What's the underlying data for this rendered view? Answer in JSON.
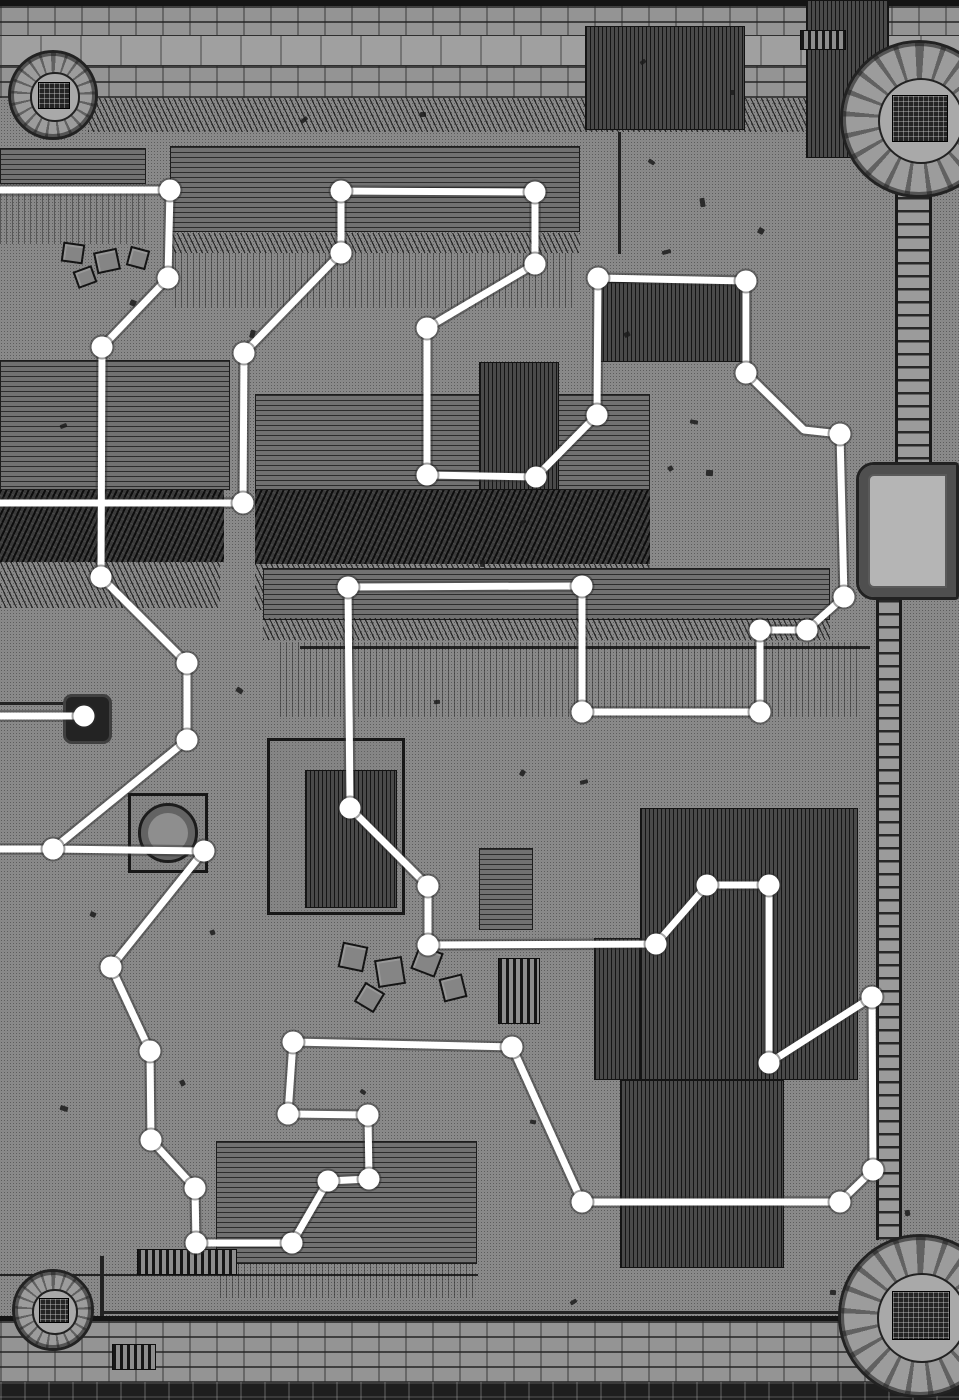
{
  "canvas": {
    "width": 959,
    "height": 1400
  },
  "colors": {
    "ground": "#a7a7a7",
    "ink": "#1b1b1b",
    "route_stroke": "#ffffff",
    "route_halo": "#2f2f2f"
  },
  "route_overlay": {
    "stroke_width": 7,
    "halo_width": 11.5,
    "node_radius": 10.5,
    "routes": [
      {
        "name": "main-route",
        "points": [
          [
            0,
            503
          ],
          [
            243,
            503
          ],
          [
            244,
            353
          ],
          [
            341,
            253
          ],
          [
            341,
            191
          ],
          [
            535,
            192
          ],
          [
            535,
            264
          ],
          [
            427,
            328
          ],
          [
            427,
            475
          ],
          [
            536,
            477
          ],
          [
            597,
            415
          ],
          [
            598,
            278
          ],
          [
            746,
            281
          ],
          [
            746,
            373
          ],
          [
            804,
            430
          ],
          [
            840,
            434
          ],
          [
            844,
            597
          ],
          [
            807,
            630
          ],
          [
            760,
            630
          ],
          [
            760,
            712
          ],
          [
            582,
            712
          ],
          [
            582,
            586
          ],
          [
            348,
            587
          ],
          [
            350,
            808
          ],
          [
            428,
            886
          ],
          [
            428,
            945
          ],
          [
            656,
            944
          ],
          [
            707,
            885
          ],
          [
            769,
            885
          ],
          [
            769,
            1063
          ],
          [
            872,
            997
          ],
          [
            873,
            1170
          ],
          [
            840,
            1202
          ],
          [
            582,
            1202
          ],
          [
            512,
            1047
          ],
          [
            293,
            1042
          ],
          [
            288,
            1114
          ],
          [
            368,
            1115
          ],
          [
            369,
            1179
          ],
          [
            328,
            1181
          ],
          [
            292,
            1243
          ],
          [
            196,
            1243
          ],
          [
            195,
            1188
          ],
          [
            151,
            1140
          ],
          [
            150,
            1051
          ],
          [
            111,
            967
          ],
          [
            204,
            851
          ],
          [
            53,
            849
          ],
          [
            187,
            740
          ],
          [
            187,
            663
          ],
          [
            101,
            577
          ],
          [
            102,
            347
          ],
          [
            168,
            278
          ],
          [
            170,
            190
          ],
          [
            0,
            190
          ]
        ]
      },
      {
        "name": "west-spur",
        "points": [
          [
            53,
            849
          ],
          [
            0,
            849
          ]
        ]
      },
      {
        "name": "well-stub",
        "points": [
          [
            84,
            716
          ],
          [
            0,
            716
          ]
        ]
      }
    ],
    "nodes": [
      [
        243,
        503
      ],
      [
        244,
        353
      ],
      [
        341,
        253
      ],
      [
        341,
        191
      ],
      [
        535,
        192
      ],
      [
        535,
        264
      ],
      [
        427,
        328
      ],
      [
        427,
        475
      ],
      [
        536,
        477
      ],
      [
        597,
        415
      ],
      [
        598,
        278
      ],
      [
        746,
        281
      ],
      [
        746,
        373
      ],
      [
        840,
        434
      ],
      [
        844,
        597
      ],
      [
        807,
        630
      ],
      [
        760,
        630
      ],
      [
        760,
        712
      ],
      [
        582,
        712
      ],
      [
        582,
        586
      ],
      [
        348,
        587
      ],
      [
        350,
        808
      ],
      [
        428,
        886
      ],
      [
        428,
        945
      ],
      [
        656,
        944
      ],
      [
        707,
        885
      ],
      [
        769,
        885
      ],
      [
        769,
        1063
      ],
      [
        872,
        997
      ],
      [
        873,
        1170
      ],
      [
        840,
        1202
      ],
      [
        582,
        1202
      ],
      [
        512,
        1047
      ],
      [
        293,
        1042
      ],
      [
        288,
        1114
      ],
      [
        368,
        1115
      ],
      [
        369,
        1179
      ],
      [
        328,
        1181
      ],
      [
        292,
        1243
      ],
      [
        196,
        1243
      ],
      [
        195,
        1188
      ],
      [
        151,
        1140
      ],
      [
        150,
        1051
      ],
      [
        111,
        967
      ],
      [
        204,
        851
      ],
      [
        53,
        849
      ],
      [
        187,
        740
      ],
      [
        187,
        663
      ],
      [
        101,
        577
      ],
      [
        102,
        347
      ],
      [
        168,
        278
      ],
      [
        170,
        190
      ],
      [
        84,
        716
      ]
    ]
  },
  "map": {
    "structures": [
      {
        "name": "north-wall-cap",
        "type": "dark",
        "x": 0,
        "y": 0,
        "w": 959,
        "h": 6
      },
      {
        "name": "north-wall-brick-upper",
        "type": "brick",
        "x": 0,
        "y": 6,
        "w": 959,
        "h": 29
      },
      {
        "name": "north-wall-walk",
        "type": "plain",
        "x": 0,
        "y": 35,
        "w": 959,
        "h": 31
      },
      {
        "name": "north-wall-brick-lower",
        "type": "brick",
        "x": 0,
        "y": 66,
        "w": 959,
        "h": 32
      },
      {
        "name": "north-wall-grass-fringe",
        "type": "hatch",
        "x": 88,
        "y": 98,
        "w": 770,
        "h": 34
      },
      {
        "name": "south-wall-line",
        "type": "dark",
        "x": 0,
        "y": 1316,
        "w": 959,
        "h": 5
      },
      {
        "name": "south-wall-brick",
        "type": "brick",
        "x": 0,
        "y": 1321,
        "w": 959,
        "h": 61
      },
      {
        "name": "south-wall-brick-dark",
        "type": "darkbrick",
        "x": 0,
        "y": 1382,
        "w": 959,
        "h": 18
      },
      {
        "name": "fence-northwest",
        "type": "planksh",
        "x": 0,
        "y": 148,
        "w": 146,
        "h": 36
      },
      {
        "name": "drips-northwest",
        "type": "drips",
        "x": 0,
        "y": 186,
        "w": 150,
        "h": 58
      },
      {
        "name": "courtyard-wall-west",
        "type": "line-h",
        "x": 0,
        "y": 702,
        "w": 68,
        "h": 3
      },
      {
        "name": "courtyard-wall-south",
        "type": "line-h",
        "x": 0,
        "y": 1274,
        "w": 478,
        "h": 2
      },
      {
        "name": "south-road-wall",
        "type": "line-h",
        "x": 100,
        "y": 1311,
        "w": 762,
        "h": 3
      },
      {
        "name": "south-wall-spur",
        "type": "line-v",
        "x": 100,
        "y": 1256,
        "w": 4,
        "h": 60
      },
      {
        "name": "north-court-post-line",
        "type": "line-v",
        "x": 618,
        "y": 132,
        "w": 3,
        "h": 122
      },
      {
        "name": "field-edge-line",
        "type": "line-h",
        "x": 300,
        "y": 646,
        "w": 570,
        "h": 3
      },
      {
        "name": "barn-north",
        "type": "planksh",
        "x": 170,
        "y": 146,
        "w": 410,
        "h": 86
      },
      {
        "name": "barn-north-eave",
        "type": "hatch",
        "x": 170,
        "y": 233,
        "w": 410,
        "h": 20
      },
      {
        "name": "barn-north-drips",
        "type": "drips",
        "x": 175,
        "y": 253,
        "w": 400,
        "h": 55
      },
      {
        "name": "shed-northeast",
        "type": "planksv",
        "x": 585,
        "y": 26,
        "w": 160,
        "h": 104
      },
      {
        "name": "store-northeast",
        "type": "planksv",
        "x": 806,
        "y": 0,
        "w": 83,
        "h": 158
      },
      {
        "name": "stable-center-north",
        "type": "planksv",
        "x": 598,
        "y": 282,
        "w": 152,
        "h": 80
      },
      {
        "name": "ladder-prop",
        "type": "stripes",
        "x": 800,
        "y": 30,
        "w": 46,
        "h": 20
      },
      {
        "name": "hall-west",
        "type": "planksh",
        "x": 0,
        "y": 360,
        "w": 230,
        "h": 130
      },
      {
        "name": "hall-west-thatch",
        "type": "thatch",
        "x": 0,
        "y": 490,
        "w": 224,
        "h": 72
      },
      {
        "name": "hall-west-fringe",
        "type": "hatch",
        "x": 0,
        "y": 562,
        "w": 220,
        "h": 46
      },
      {
        "name": "hall-center",
        "type": "planksh",
        "x": 255,
        "y": 394,
        "w": 395,
        "h": 96
      },
      {
        "name": "hall-center-thatch",
        "type": "thatch",
        "x": 255,
        "y": 490,
        "w": 395,
        "h": 74
      },
      {
        "name": "hall-center-fringe",
        "type": "hatch",
        "x": 255,
        "y": 564,
        "w": 395,
        "h": 46
      },
      {
        "name": "annex-center",
        "type": "planksv",
        "x": 479,
        "y": 362,
        "w": 80,
        "h": 128
      },
      {
        "name": "field-rows",
        "type": "planksh",
        "x": 263,
        "y": 568,
        "w": 567,
        "h": 52
      },
      {
        "name": "field-furrow-fringe",
        "type": "hatch",
        "x": 263,
        "y": 618,
        "w": 567,
        "h": 22
      },
      {
        "name": "field-drips",
        "type": "drips",
        "x": 280,
        "y": 642,
        "w": 580,
        "h": 75
      },
      {
        "name": "round-hut-plot",
        "type": "outline",
        "x": 128,
        "y": 793,
        "w": 80,
        "h": 80
      },
      {
        "name": "round-hut",
        "type": "circle",
        "x": 138,
        "y": 803,
        "w": 60,
        "h": 60
      },
      {
        "name": "warehouse-center",
        "type": "outline",
        "x": 267,
        "y": 738,
        "w": 138,
        "h": 177
      },
      {
        "name": "warehouse-center-roof",
        "type": "planksv",
        "x": 305,
        "y": 770,
        "w": 92,
        "h": 138
      },
      {
        "name": "shed-mid-east",
        "type": "planksh",
        "x": 479,
        "y": 848,
        "w": 54,
        "h": 82
      },
      {
        "name": "barrel-stack",
        "type": "stripes",
        "x": 498,
        "y": 958,
        "w": 42,
        "h": 66
      },
      {
        "name": "great-barn-east",
        "type": "planksv",
        "x": 640,
        "y": 808,
        "w": 218,
        "h": 272
      },
      {
        "name": "barn-east-annex",
        "type": "planksv",
        "x": 594,
        "y": 938,
        "w": 46,
        "h": 142
      },
      {
        "name": "great-barn-south",
        "type": "planksv",
        "x": 620,
        "y": 1080,
        "w": 164,
        "h": 188
      },
      {
        "name": "lodge-southwest",
        "type": "planksh",
        "x": 216,
        "y": 1141,
        "w": 261,
        "h": 123
      },
      {
        "name": "lodge-southwest-drips",
        "type": "drips",
        "x": 220,
        "y": 1264,
        "w": 255,
        "h": 34
      },
      {
        "name": "well-house",
        "type": "darksq",
        "x": 63,
        "y": 694,
        "w": 49,
        "h": 50
      },
      {
        "name": "east-wall-north",
        "type": "ladder",
        "x": 895,
        "y": 132,
        "w": 37,
        "h": 330
      },
      {
        "name": "gatehouse-east",
        "type": "gate",
        "x": 856,
        "y": 462,
        "w": 103,
        "h": 138
      },
      {
        "name": "east-wall-south",
        "type": "ladder",
        "x": 876,
        "y": 600,
        "w": 26,
        "h": 640
      },
      {
        "name": "crate-1",
        "type": "crate",
        "x": 340,
        "y": 944,
        "w": 26,
        "h": 26,
        "rot": 12
      },
      {
        "name": "crate-2",
        "type": "crate",
        "x": 376,
        "y": 958,
        "w": 28,
        "h": 28,
        "rot": -9
      },
      {
        "name": "crate-3",
        "type": "crate",
        "x": 414,
        "y": 948,
        "w": 26,
        "h": 26,
        "rot": 21
      },
      {
        "name": "crate-4",
        "type": "crate",
        "x": 441,
        "y": 976,
        "w": 24,
        "h": 24,
        "rot": -14
      },
      {
        "name": "crate-5",
        "type": "crate",
        "x": 358,
        "y": 986,
        "w": 23,
        "h": 23,
        "rot": 31
      },
      {
        "name": "crate-6",
        "type": "crate",
        "x": 62,
        "y": 243,
        "w": 22,
        "h": 20,
        "rot": 8
      },
      {
        "name": "crate-7",
        "type": "crate",
        "x": 95,
        "y": 250,
        "w": 24,
        "h": 22,
        "rot": -12
      },
      {
        "name": "crate-8",
        "type": "crate",
        "x": 128,
        "y": 248,
        "w": 20,
        "h": 20,
        "rot": 15
      },
      {
        "name": "crate-9",
        "type": "crate",
        "x": 75,
        "y": 268,
        "w": 20,
        "h": 18,
        "rot": -20
      },
      {
        "name": "crate-stripe-south",
        "type": "stripes",
        "x": 112,
        "y": 1344,
        "w": 44,
        "h": 26
      },
      {
        "name": "crate-stripe-mid",
        "type": "stripes",
        "x": 137,
        "y": 1249,
        "w": 100,
        "h": 26
      },
      {
        "name": "tower-northwest",
        "type": "tower",
        "x": 8,
        "y": 50,
        "w": 84,
        "h": 84
      },
      {
        "name": "tower-northeast",
        "type": "tower",
        "x": 840,
        "y": 40,
        "w": 152,
        "h": 152
      },
      {
        "name": "tower-southwest",
        "type": "tower",
        "x": 12,
        "y": 1269,
        "w": 76,
        "h": 76
      },
      {
        "name": "tower-southeast",
        "type": "tower",
        "x": 838,
        "y": 1234,
        "w": 158,
        "h": 158
      }
    ],
    "specks": [
      [
        300,
        118,
        8,
        4
      ],
      [
        420,
        112,
        6,
        5
      ],
      [
        648,
        160,
        7,
        4
      ],
      [
        700,
        198,
        5,
        9
      ],
      [
        758,
        228,
        6,
        6
      ],
      [
        662,
        250,
        9,
        4
      ],
      [
        130,
        300,
        6,
        6
      ],
      [
        60,
        424,
        7,
        4
      ],
      [
        250,
        330,
        5,
        8
      ],
      [
        624,
        332,
        6,
        5
      ],
      [
        690,
        420,
        8,
        4
      ],
      [
        668,
        466,
        5,
        5
      ],
      [
        706,
        470,
        7,
        6
      ],
      [
        520,
        520,
        6,
        4
      ],
      [
        480,
        560,
        5,
        7
      ],
      [
        236,
        688,
        7,
        5
      ],
      [
        434,
        700,
        6,
        4
      ],
      [
        520,
        770,
        5,
        6
      ],
      [
        580,
        780,
        8,
        4
      ],
      [
        90,
        912,
        6,
        5
      ],
      [
        210,
        930,
        5,
        5
      ],
      [
        60,
        1106,
        8,
        5
      ],
      [
        180,
        1080,
        5,
        6
      ],
      [
        530,
        1120,
        6,
        4
      ],
      [
        570,
        1300,
        7,
        4
      ],
      [
        830,
        1290,
        6,
        5
      ],
      [
        640,
        60,
        6,
        4
      ],
      [
        730,
        90,
        5,
        5
      ],
      [
        360,
        1090,
        6,
        4
      ],
      [
        905,
        1210,
        5,
        6
      ]
    ]
  }
}
